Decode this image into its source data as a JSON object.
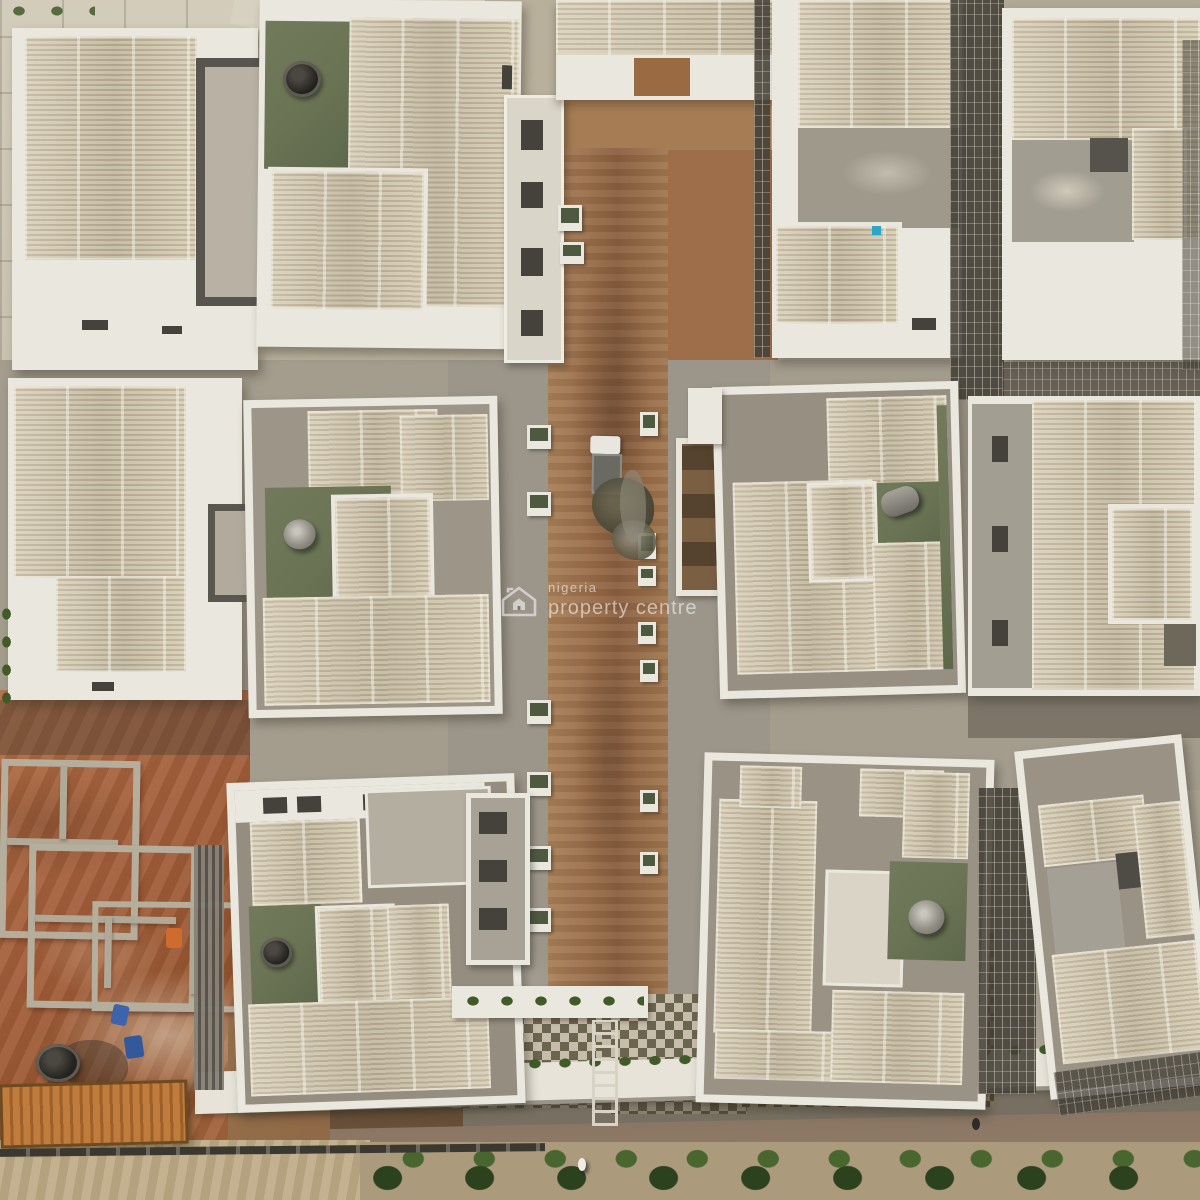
{
  "scene": {
    "description": "Aerial drone photograph of a residential housing estate under construction: grid of white villas with tan corrugated roofs, central dirt access road, red-earth foundation area at lower left, perimeter sidewalk and tree-lined road at bottom",
    "watermark": {
      "brand_line1": "nigeria",
      "brand_line2": "property centre",
      "icon": "house-logo-icon",
      "color": "#ffffff"
    }
  },
  "palette": {
    "roof_tan": "#d7cdb5",
    "roof_tan_line": "#bdb096",
    "wall_white": "#eae7de",
    "concrete": "#a49e90",
    "green_roof": "#6a7354",
    "dirt_road": "#9b6f4b",
    "red_earth": "#a5613c",
    "paver_light": "#c6bdaa",
    "paver_dark": "#6b644f",
    "vegetation": "#43552a",
    "container_orange": "#bf7c3d",
    "shadow_dark": "#3f3a30"
  }
}
